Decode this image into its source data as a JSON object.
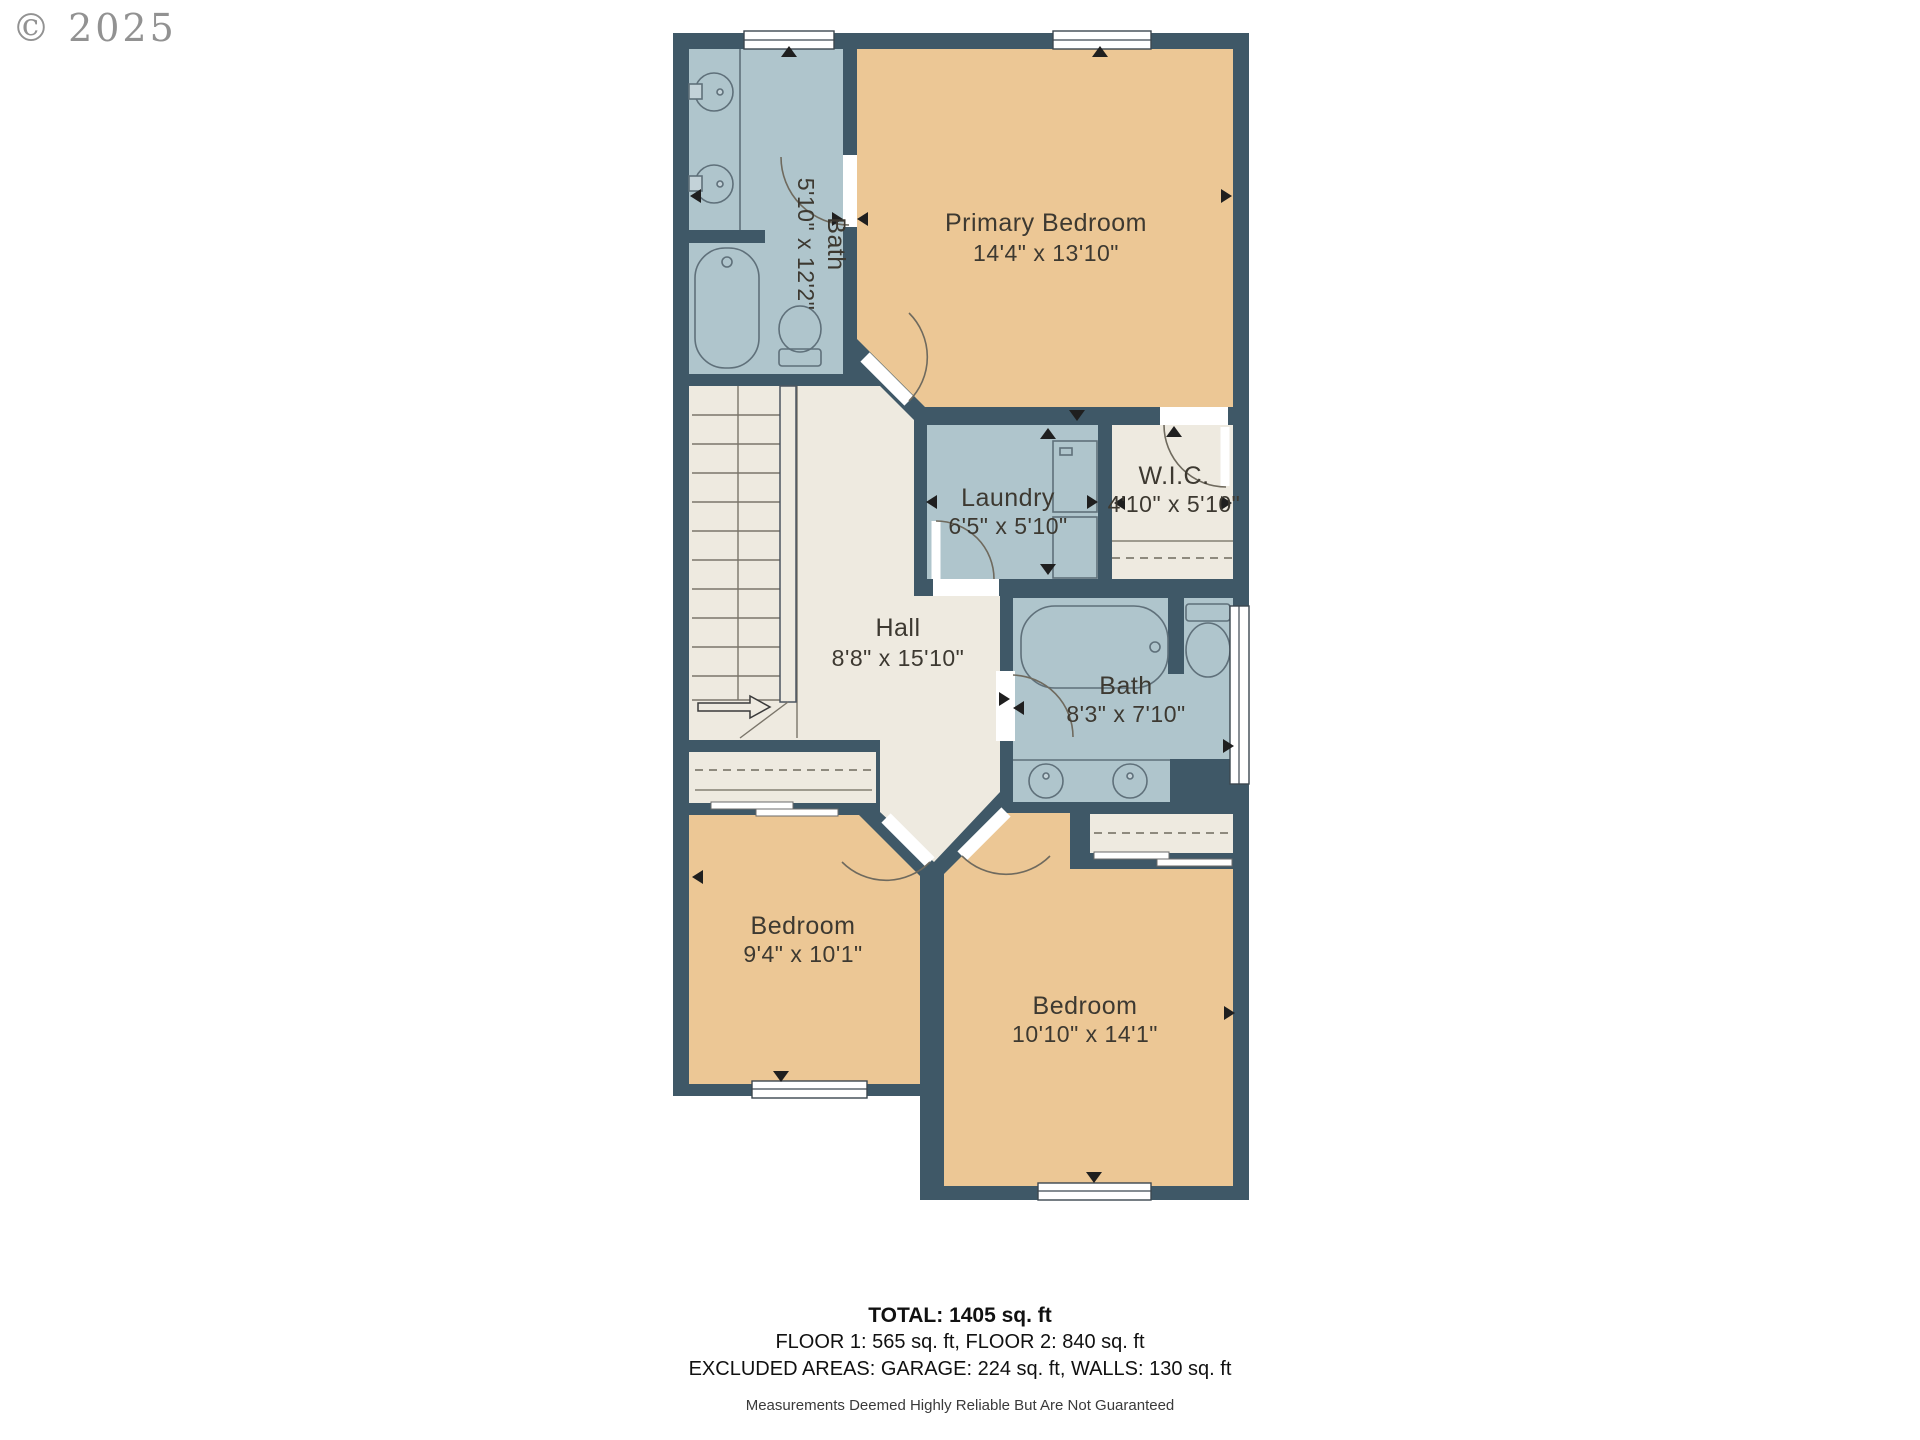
{
  "copyright": "© 2025",
  "rooms": [
    {
      "name": "Bath",
      "dims": "5'10\" x 12'2\""
    },
    {
      "name": "Primary Bedroom",
      "dims": "14'4\" x 13'10\""
    },
    {
      "name": "Laundry",
      "dims": "6'5\" x 5'10\""
    },
    {
      "name": "W.I.C.",
      "dims": "4'10\" x 5'10\""
    },
    {
      "name": "Hall",
      "dims": "8'8\" x 15'10\""
    },
    {
      "name": "Bath",
      "dims": "8'3\" x 7'10\""
    },
    {
      "name": "Bedroom",
      "dims": "9'4\" x 10'1\""
    },
    {
      "name": "Bedroom",
      "dims": "10'10\" x 14'1\""
    }
  ],
  "summary": {
    "total": "TOTAL: 1405 sq. ft",
    "floors": "FLOOR 1: 565 sq. ft, FLOOR 2: 840 sq. ft",
    "excluded": "EXCLUDED AREAS: GARAGE: 224 sq. ft, WALLS: 130 sq. ft",
    "disclaimer": "Measurements Deemed Highly Reliable But Are Not Guaranteed"
  },
  "colors": {
    "wall": "#3f5867",
    "wet_room_fill": "#afc5cc",
    "bedroom_fill": "#ecc795",
    "hall_fill": "#eeeae0",
    "fixture_line": "#5f707a",
    "label_text": "#3d3931",
    "marker": "#1f1f1f",
    "copyright_gray": "#929292"
  }
}
